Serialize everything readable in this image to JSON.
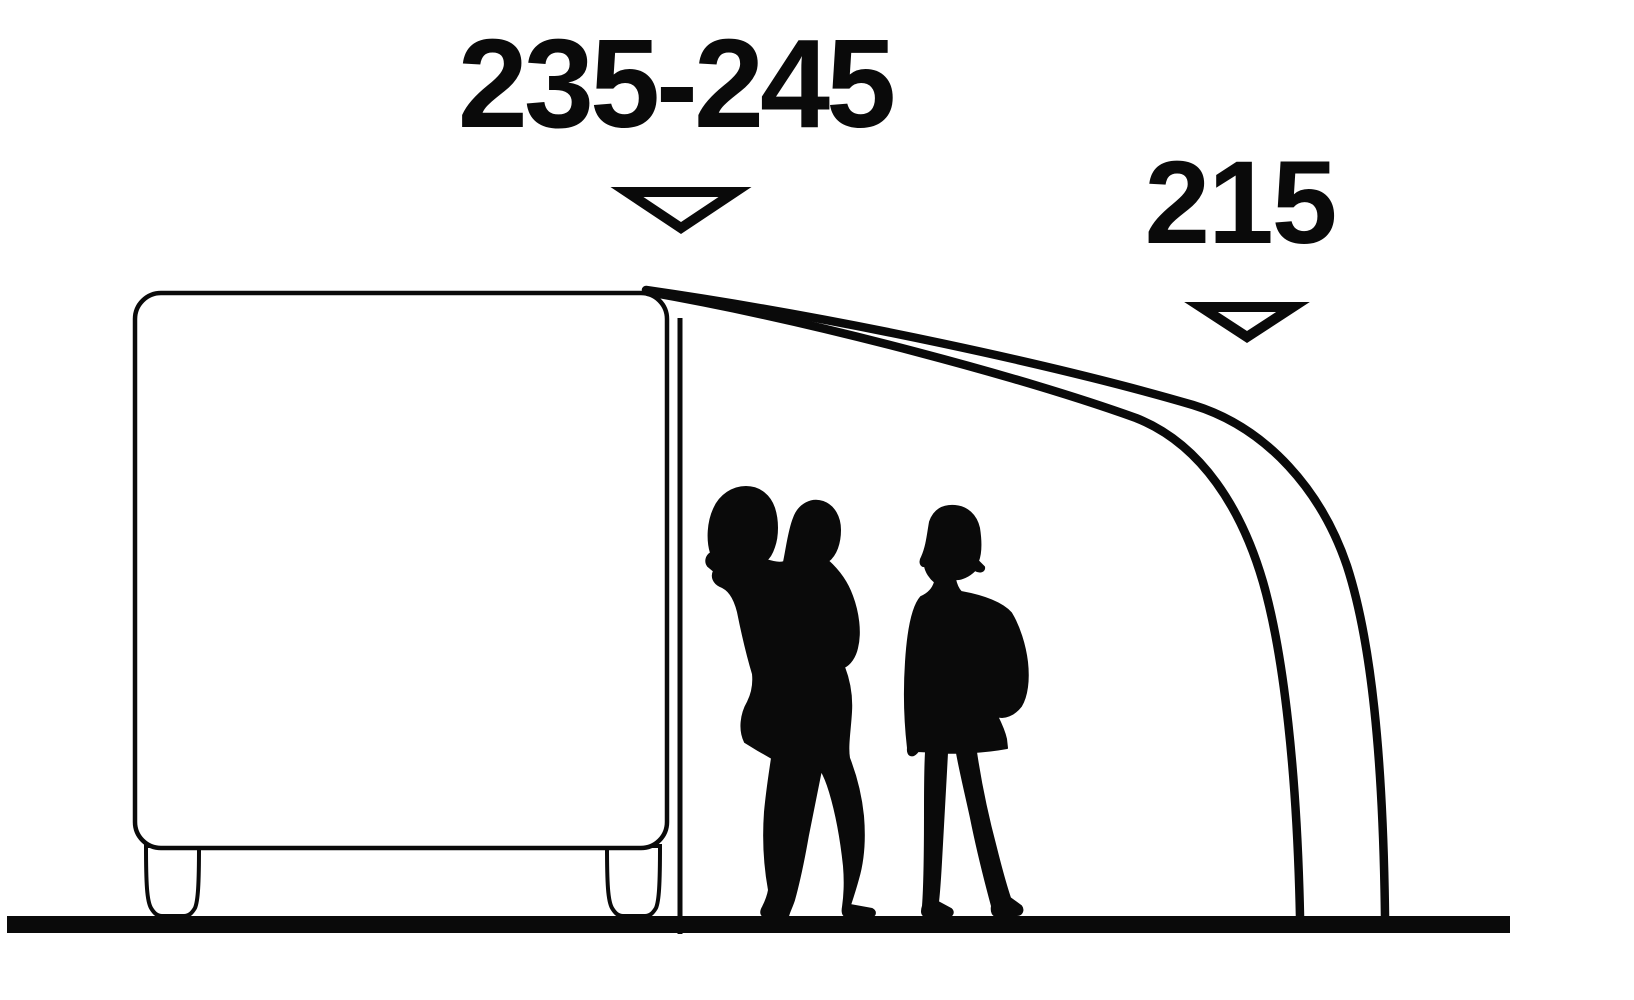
{
  "diagram": {
    "title": "caravan-awning-size-diagram",
    "background_color": "#ffffff",
    "line_color": "#0a0a0a",
    "measurements": [
      {
        "id": "attachment-height-range",
        "value": "235-245",
        "marker_icon": "triangle-down-icon"
      },
      {
        "id": "front-height",
        "value": "215",
        "marker_icon": "triangle-down-icon"
      }
    ],
    "elements": [
      "caravan-side-profile",
      "awning-side-panel-edge",
      "awning-frame-outer-tube",
      "awning-frame-inner-tube",
      "adult-carrying-child-silhouette",
      "standing-person-silhouette",
      "ground-line"
    ]
  }
}
